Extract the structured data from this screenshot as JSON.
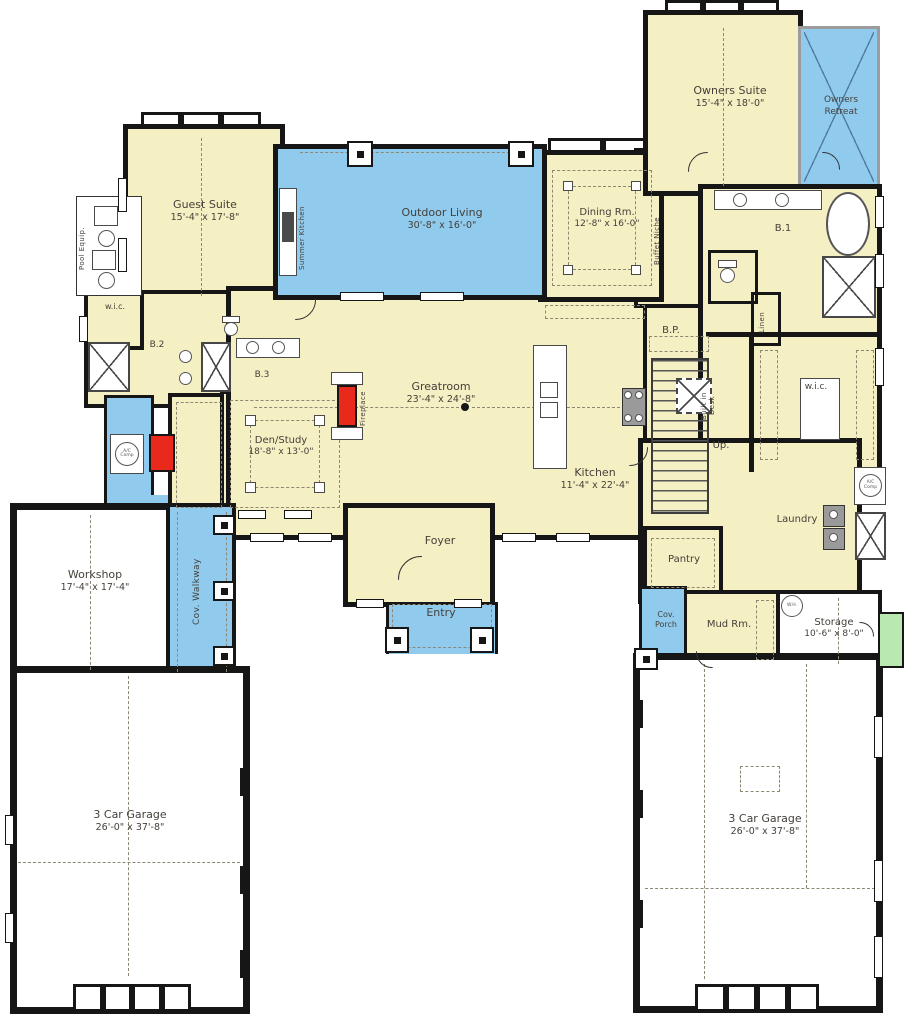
{
  "colors": {
    "floor": "#f5efc4",
    "outdoor": "#90cbee",
    "wall": "#161616",
    "garage": "#ffffff",
    "fireplace_red": "#e8291c",
    "stoop_green": "#b9e8b0",
    "text": "#45413a"
  },
  "rooms": {
    "owners_suite": {
      "name": "Owners Suite",
      "dims": "15'-4\" x 18'-0\""
    },
    "owners_retreat": {
      "line1": "Owners",
      "line2": "Retreat"
    },
    "b1": {
      "name": "B.1"
    },
    "guest_suite": {
      "name": "Guest Suite",
      "dims": "15'-4\" x 17'-8\""
    },
    "wic_left": {
      "name": "w.i.c."
    },
    "b2": {
      "name": "B.2"
    },
    "b3": {
      "name": "B.3"
    },
    "outdoor_living": {
      "name": "Outdoor Living",
      "dims": "30'-8\" x 16'-0\""
    },
    "summer_kitchen": {
      "name": "Summer Kitchen"
    },
    "dining": {
      "name": "Dining Rm.",
      "dims": "12'-8\" x 16'-0\""
    },
    "buffet_niche": {
      "name": "Buffet Niche"
    },
    "greatroom": {
      "name": "Greatroom",
      "dims": "23'-4\" x 24'-8\""
    },
    "fireplace": {
      "name": "Fireplace"
    },
    "den": {
      "name": "Den/Study",
      "dims": "18'-8\" x 13'-0\""
    },
    "kitchen": {
      "name": "Kitchen",
      "dims": "11'-4\" x 22'-4\""
    },
    "bp": {
      "name": "B.P."
    },
    "up": {
      "name": "Up."
    },
    "built_in_desk": {
      "name": "Built in Desk"
    },
    "linen": {
      "name": "Linen"
    },
    "wic_right": {
      "name": "w.i.c."
    },
    "laundry": {
      "name": "Laundry"
    },
    "pantry": {
      "name": "Pantry"
    },
    "foyer": {
      "name": "Foyer"
    },
    "entry": {
      "name": "Entry"
    },
    "cov_walkway": {
      "name": "Cov. Walkway"
    },
    "workshop": {
      "name": "Workshop",
      "dims": "17'-4\" x 17'-4\""
    },
    "garage_left": {
      "name": "3 Car Garage",
      "dims": "26'-0\" x 37'-8\""
    },
    "garage_right": {
      "name": "3 Car Garage",
      "dims": "26'-0\" x 37'-8\""
    },
    "cov_porch": {
      "line1": "Cov.",
      "line2": "Porch"
    },
    "mud": {
      "name": "Mud Rm."
    },
    "storage": {
      "name": "Storage",
      "dims": "10'-6\" x 8'-0\""
    },
    "wh": {
      "name": "W.H."
    },
    "ac_comp": {
      "name": "A/C Comp"
    },
    "pool_equip": {
      "name": "Pool Equip."
    }
  }
}
